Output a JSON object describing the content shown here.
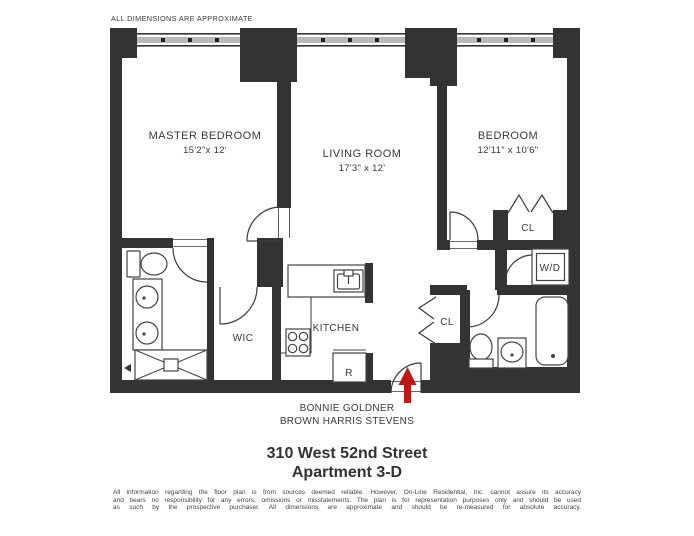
{
  "header": {
    "note": "ALL DIMENSIONS ARE APPROXIMATE"
  },
  "rooms": {
    "master_bedroom": {
      "name": "MASTER BEDROOM",
      "dims": "15'2\"x 12'"
    },
    "living_room": {
      "name": "LIVING ROOM",
      "dims": "17'3\" x 12'"
    },
    "bedroom": {
      "name": "BEDROOM",
      "dims": "12'11\" x 10'6\""
    },
    "kitchen": {
      "name": "KITCHEN"
    },
    "walk_in_closet": {
      "name": "WIC"
    },
    "bedroom_closet": {
      "name": "CL"
    },
    "entry_closet": {
      "name": "CL"
    },
    "washer_dryer": {
      "name": "W/D"
    },
    "refrigerator": {
      "name": "R"
    }
  },
  "footer": {
    "agent": "BONNIE GOLDNER",
    "brokerage": "BROWN HARRIS STEVENS",
    "address": "310 West 52nd Street",
    "apartment": "Apartment 3-D",
    "disclaimer_lines": [
      "All information regarding the floor plan is from sources deemed reliable. However, On-Line Residential, Inc. cannot assure its accuracy",
      "and bears no responsibility for any errors, omissions or misstatements. The plan is for representation purposes only and should be used",
      "as such by the prospective purchaser. All dimensions are approximate and should be re-measured for absolute accuracy."
    ]
  },
  "colors": {
    "wall": "#333333",
    "window_band": "#b8b8b8",
    "entry_arrow": "#bf1616"
  }
}
